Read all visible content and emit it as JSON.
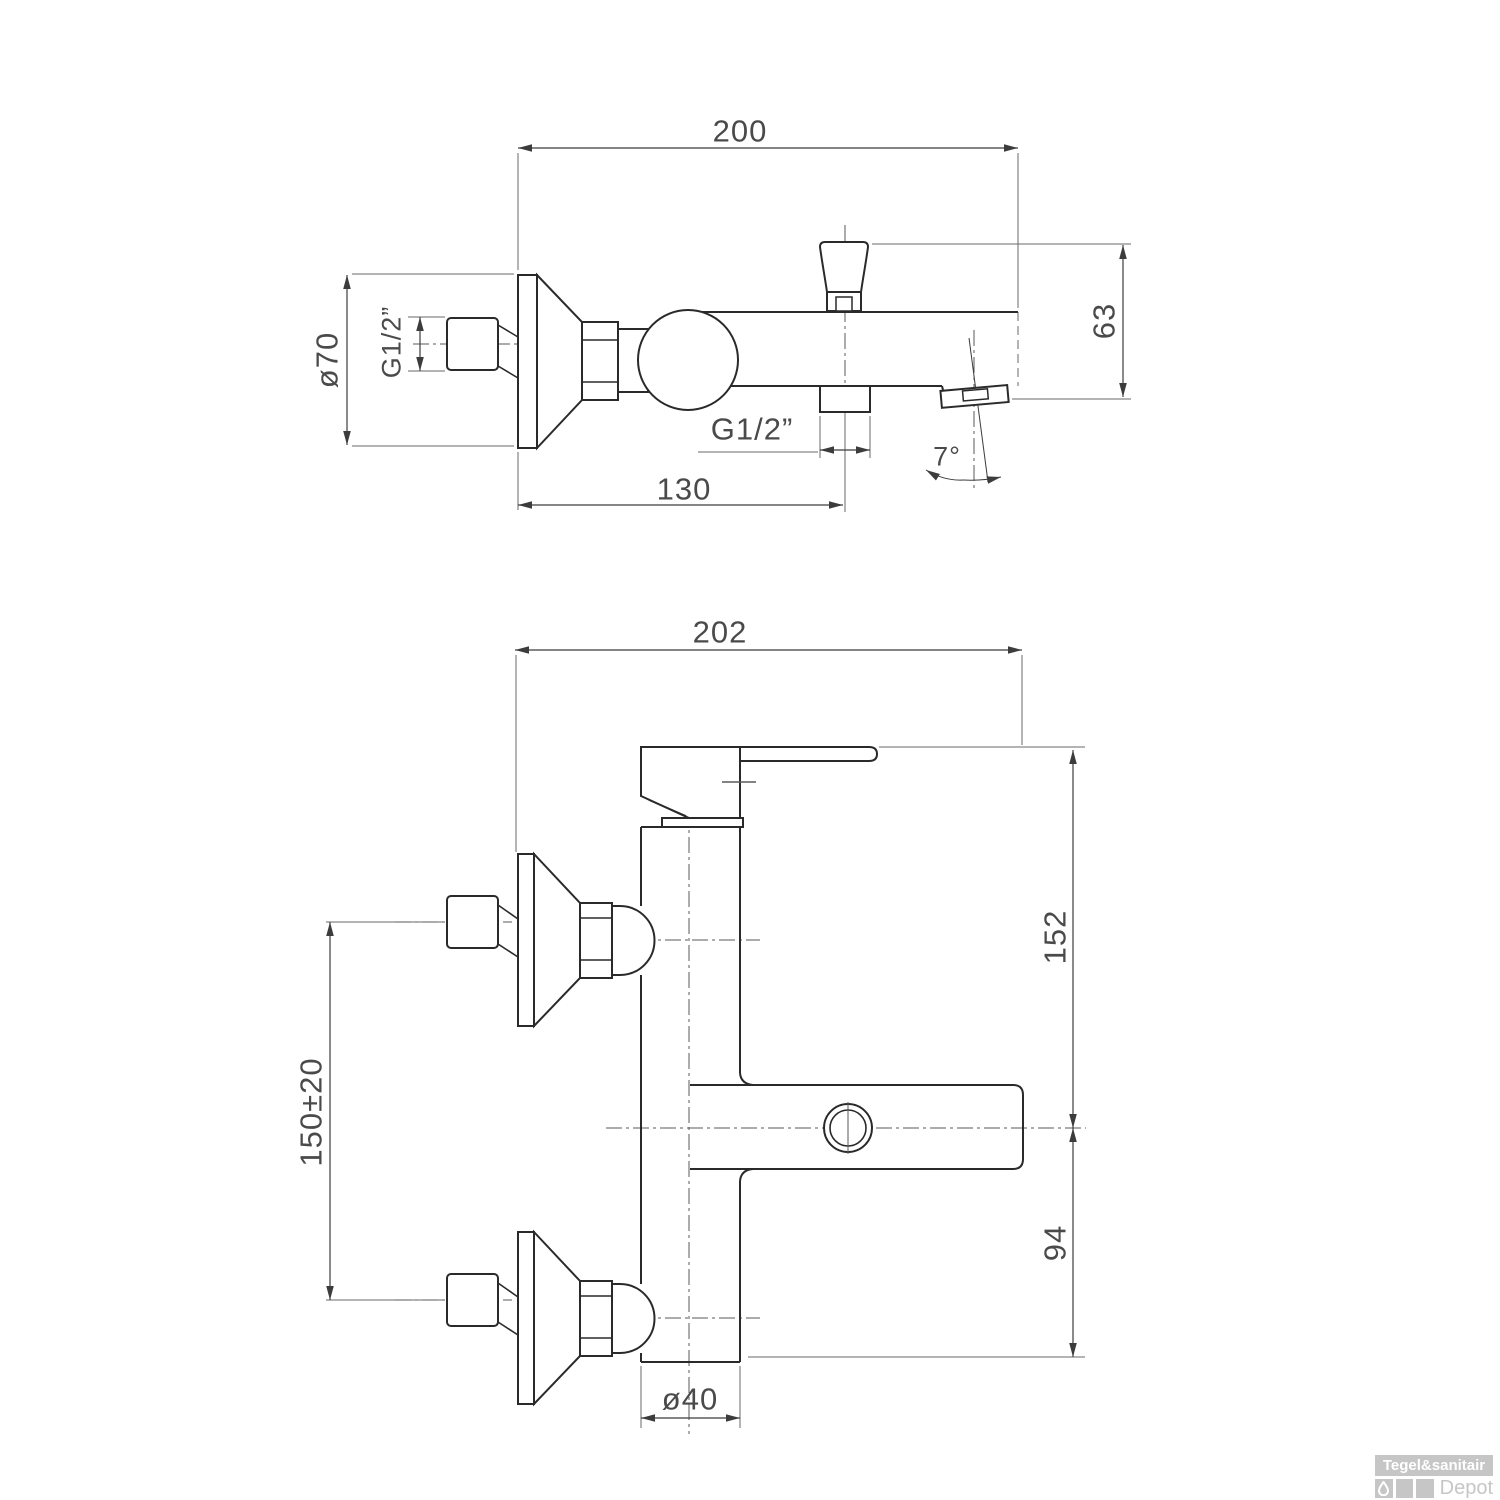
{
  "top_view": {
    "dim_total_width": "200",
    "dim_spout_height": "63",
    "dim_escutcheon": "ø70",
    "dim_wall_thread": "G1/2”",
    "dim_outlet_thread": "G1/2”",
    "dim_wall_to_outlet": "130",
    "dim_spout_angle": "7°"
  },
  "front_view": {
    "dim_total_width": "202",
    "dim_handle_to_spout": "152",
    "dim_spout_to_bottom": "94",
    "dim_connection_centers": "150±20",
    "dim_body_diameter": "ø40"
  },
  "logo": {
    "brand": "Tegel&sanitair",
    "suffix": "Depot"
  },
  "colors": {
    "object_line": "#2a2a2a",
    "dim_line": "#4a4a4a",
    "logo_gray": "#c6c6c6"
  }
}
